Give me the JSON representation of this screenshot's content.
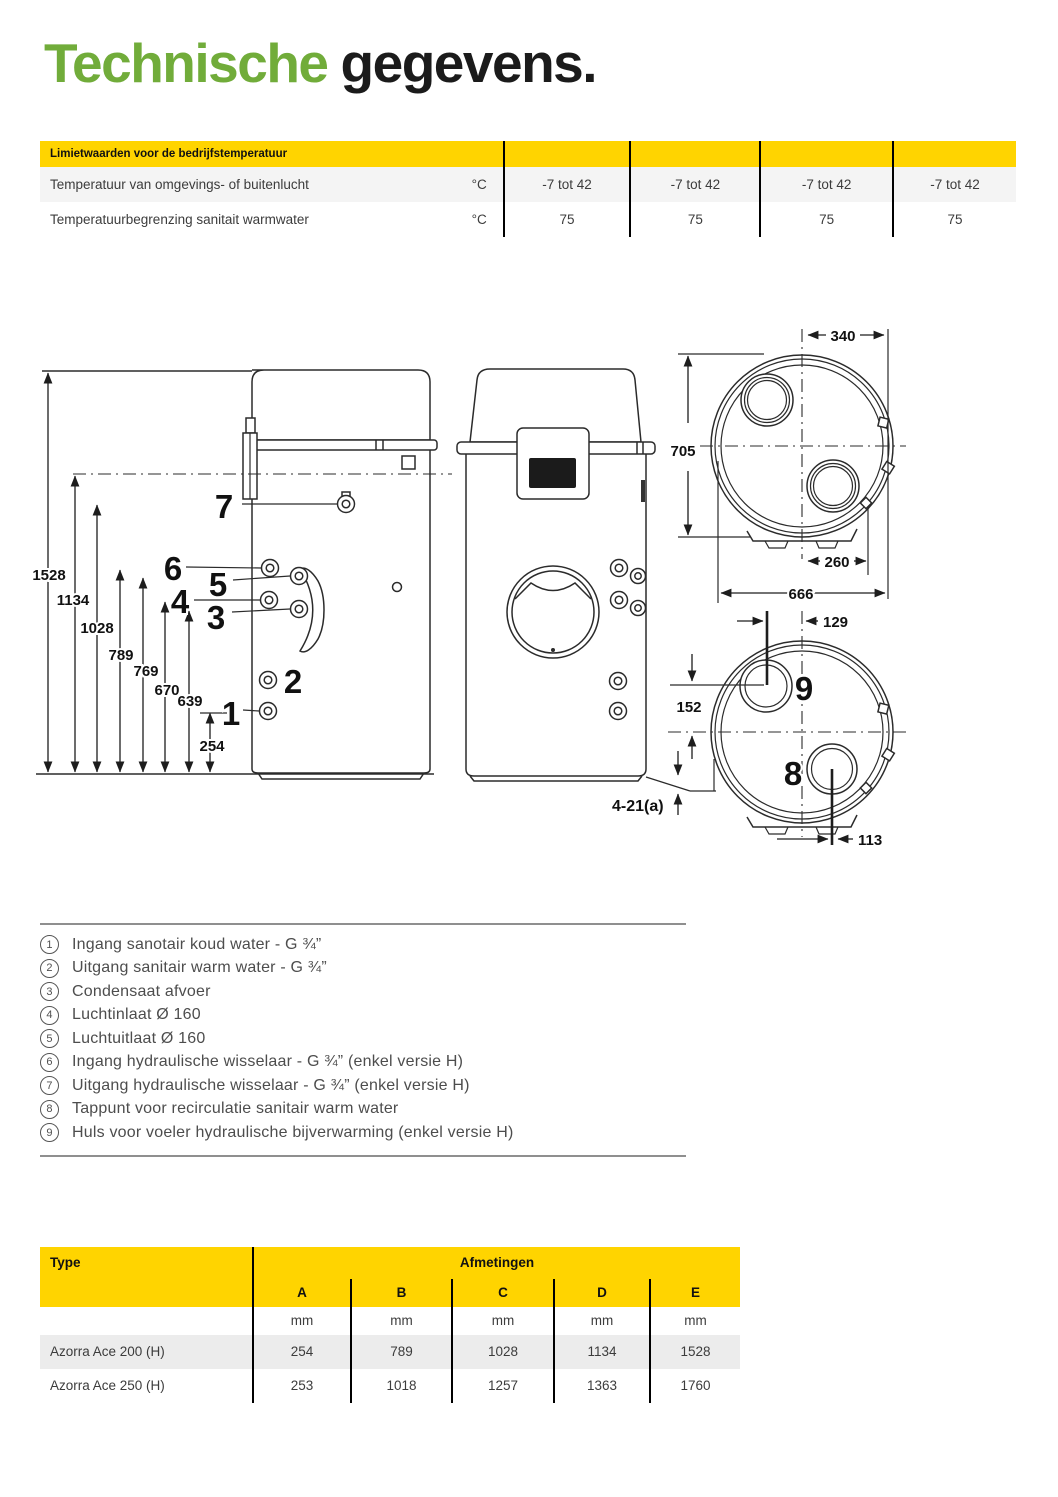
{
  "title": {
    "part1": "Technische",
    "part2": "gegevens."
  },
  "colors": {
    "accent_green": "#71AC3A",
    "brand_yellow": "#FFD400"
  },
  "limits_table": {
    "header": "Limietwaarden voor de bedrijfstemperatuur",
    "rows": [
      {
        "label": "Temperatuur van omgevings- of buitenlucht",
        "unit": "°C",
        "values": [
          "-7 tot 42",
          "-7 tot 42",
          "-7 tot 42",
          "-7 tot 42"
        ]
      },
      {
        "label": "Temperatuurbegrenzing sanitait warmwater",
        "unit": "°C",
        "values": [
          "75",
          "75",
          "75",
          "75"
        ]
      }
    ]
  },
  "diagram": {
    "side_dims": [
      "1528",
      "1134",
      "1028",
      "789",
      "769",
      "670",
      "639",
      "254"
    ],
    "side_callouts": [
      "7",
      "6",
      "5",
      "4",
      "3",
      "2",
      "1"
    ],
    "top_dims": {
      "width_top": "340",
      "height": "705",
      "width_mid": "260",
      "width_total": "666"
    },
    "bottom_dims": {
      "offset_top": "129",
      "offset_left": "152",
      "offset_bottom": "113"
    },
    "bottom_callouts": [
      "9",
      "8"
    ],
    "note": "4-21(a)"
  },
  "legend": {
    "items": [
      {
        "num": "1",
        "text": "Ingang sanotair koud water - G ¾”"
      },
      {
        "num": "2",
        "text": "Uitgang sanitair warm water - G ¾”"
      },
      {
        "num": "3",
        "text": "Condensaat afvoer"
      },
      {
        "num": "4",
        "text": "Luchtinlaat Ø 160"
      },
      {
        "num": "5",
        "text": "Luchtuitlaat Ø 160"
      },
      {
        "num": "6",
        "text": "Ingang hydraulische wisselaar - G ¾” (enkel versie H)"
      },
      {
        "num": "7",
        "text": "Uitgang hydraulische wisselaar - G ¾” (enkel versie H)"
      },
      {
        "num": "8",
        "text": "Tappunt voor recirculatie sanitair warm water"
      },
      {
        "num": "9",
        "text": "Huls voor voeler hydraulische bijverwarming (enkel versie H)"
      }
    ]
  },
  "dims_table": {
    "type_header": "Type",
    "group_header": "Afmetingen",
    "columns": [
      "A",
      "B",
      "C",
      "D",
      "E"
    ],
    "units": [
      "mm",
      "mm",
      "mm",
      "mm",
      "mm"
    ],
    "rows": [
      {
        "name": "Azorra Ace 200 (H)",
        "values": [
          "254",
          "789",
          "1028",
          "1134",
          "1528"
        ]
      },
      {
        "name": "Azorra Ace 250 (H)",
        "values": [
          "253",
          "1018",
          "1257",
          "1363",
          "1760"
        ]
      }
    ]
  }
}
